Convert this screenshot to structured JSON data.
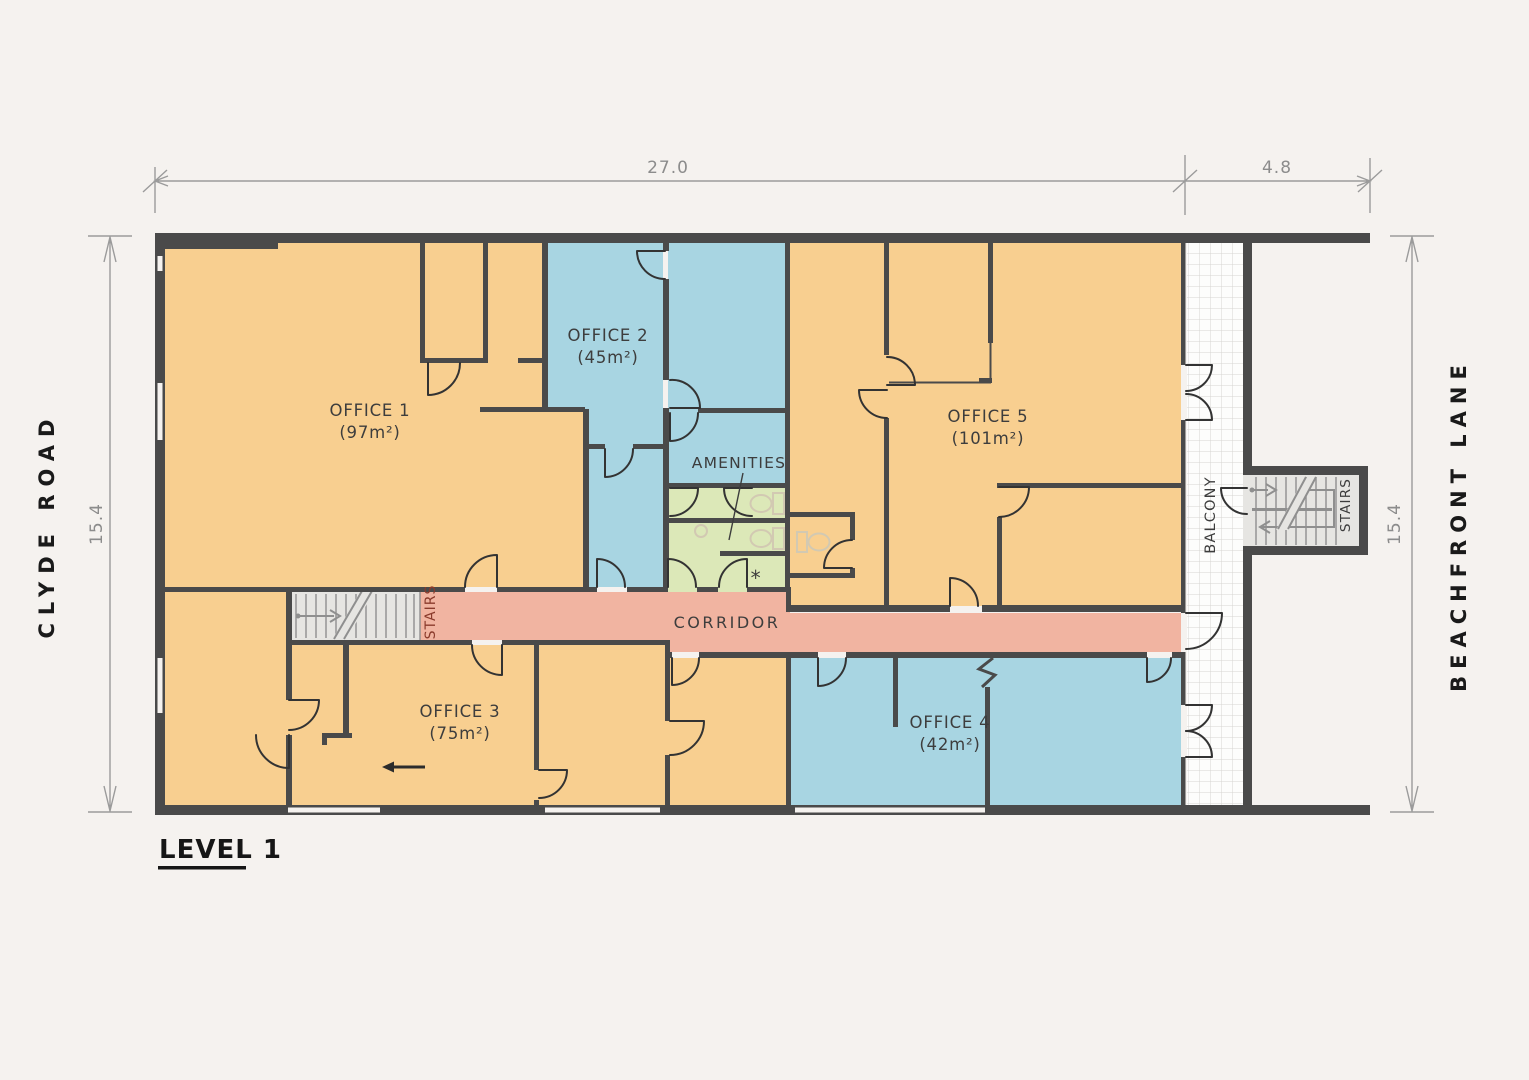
{
  "palette": {
    "background": "#f5f2ef",
    "wall": "#4a4a4a",
    "room_orange": "#f8cf90",
    "room_blue": "#a8d5e2",
    "room_green": "#dce8b8",
    "corridor_pink": "#f1b4a1",
    "stair_fill": "#e6e5e2",
    "stair_line": "#8f8f8f",
    "balcony_fill": "#fdfdfc",
    "balcony_grid": "#d7d5d2",
    "door_line": "#333333",
    "fixture_line": "#d2c9b2",
    "dim_line": "#9b9b9b",
    "dim_text": "#8c8c8c",
    "label_text": "#3d3d3d",
    "stairs_red_text": "#8a3a2b",
    "street_text": "#1a1a1a"
  },
  "title": {
    "label": "LEVEL 1"
  },
  "streets": {
    "left": "CLYDE ROAD",
    "right": "BEACHFRONT LANE"
  },
  "dimensions": {
    "top_main": "27.0",
    "top_right": "4.8",
    "left_side": "15.4",
    "right_side": "15.4"
  },
  "rooms": {
    "office1": {
      "name": "OFFICE 1",
      "area": "(97m²)"
    },
    "office2": {
      "name": "OFFICE 2",
      "area": "(45m²)"
    },
    "office3": {
      "name": "OFFICE 3",
      "area": "(75m²)"
    },
    "office4": {
      "name": "OFFICE 4",
      "area": "(42m²)"
    },
    "office5": {
      "name": "OFFICE 5",
      "area": "(101m²)"
    },
    "corridor": {
      "name": "CORRIDOR"
    },
    "amenities": {
      "name": "AMENITIES",
      "note": "*"
    },
    "balcony": {
      "name": "BALCONY"
    },
    "stairs_left": {
      "name": "STAIRS"
    },
    "stairs_right": {
      "name": "STAIRS"
    }
  }
}
